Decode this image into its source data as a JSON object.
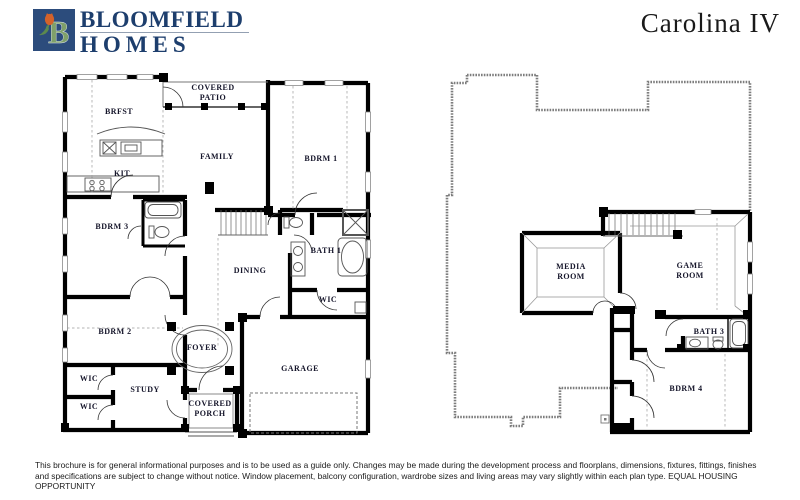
{
  "header": {
    "logo": {
      "line1": "BLOOMFIELD",
      "line2": "HOMES",
      "mark": "bloomfield-tulip-b"
    },
    "plan_title": "Carolina IV"
  },
  "floor1": {
    "rooms": [
      {
        "label": "COVERED\nPATIO"
      },
      {
        "label": "BRFST"
      },
      {
        "label": "FAMILY"
      },
      {
        "label": "BDRM 1"
      },
      {
        "label": "KIT"
      },
      {
        "label": "BDRM 3"
      },
      {
        "label": "BATH 1"
      },
      {
        "label": "DINING"
      },
      {
        "label": "WIC"
      },
      {
        "label": "BDRM 2"
      },
      {
        "label": "FOYER"
      },
      {
        "label": "WIC"
      },
      {
        "label": "STUDY"
      },
      {
        "label": "WIC"
      },
      {
        "label": "COVERED\nPORCH"
      },
      {
        "label": "GARAGE"
      }
    ]
  },
  "floor2": {
    "rooms": [
      {
        "label": "MEDIA\nROOM"
      },
      {
        "label": "GAME\nROOM"
      },
      {
        "label": "BATH 3"
      },
      {
        "label": "BDRM 4"
      }
    ]
  },
  "footer": {
    "disclaimer": "This brochure is for general informational purposes and is to be used as a guide only. Changes may be made during the development process and floorplans, dimensions, fixtures, fittings, finishes and specifications are subject to change without notice. Window placement, balcony configuration, wardrobe sizes and living areas may vary slightly within each plan type.  EQUAL HOUSING OPPORTUNITY"
  },
  "colors": {
    "wall": "#000000",
    "outline_gray": "#7d7d7d",
    "logo_navy": "#1d3e6d",
    "logo_green": "#7fa06a",
    "logo_tulip": "#d4622a"
  }
}
